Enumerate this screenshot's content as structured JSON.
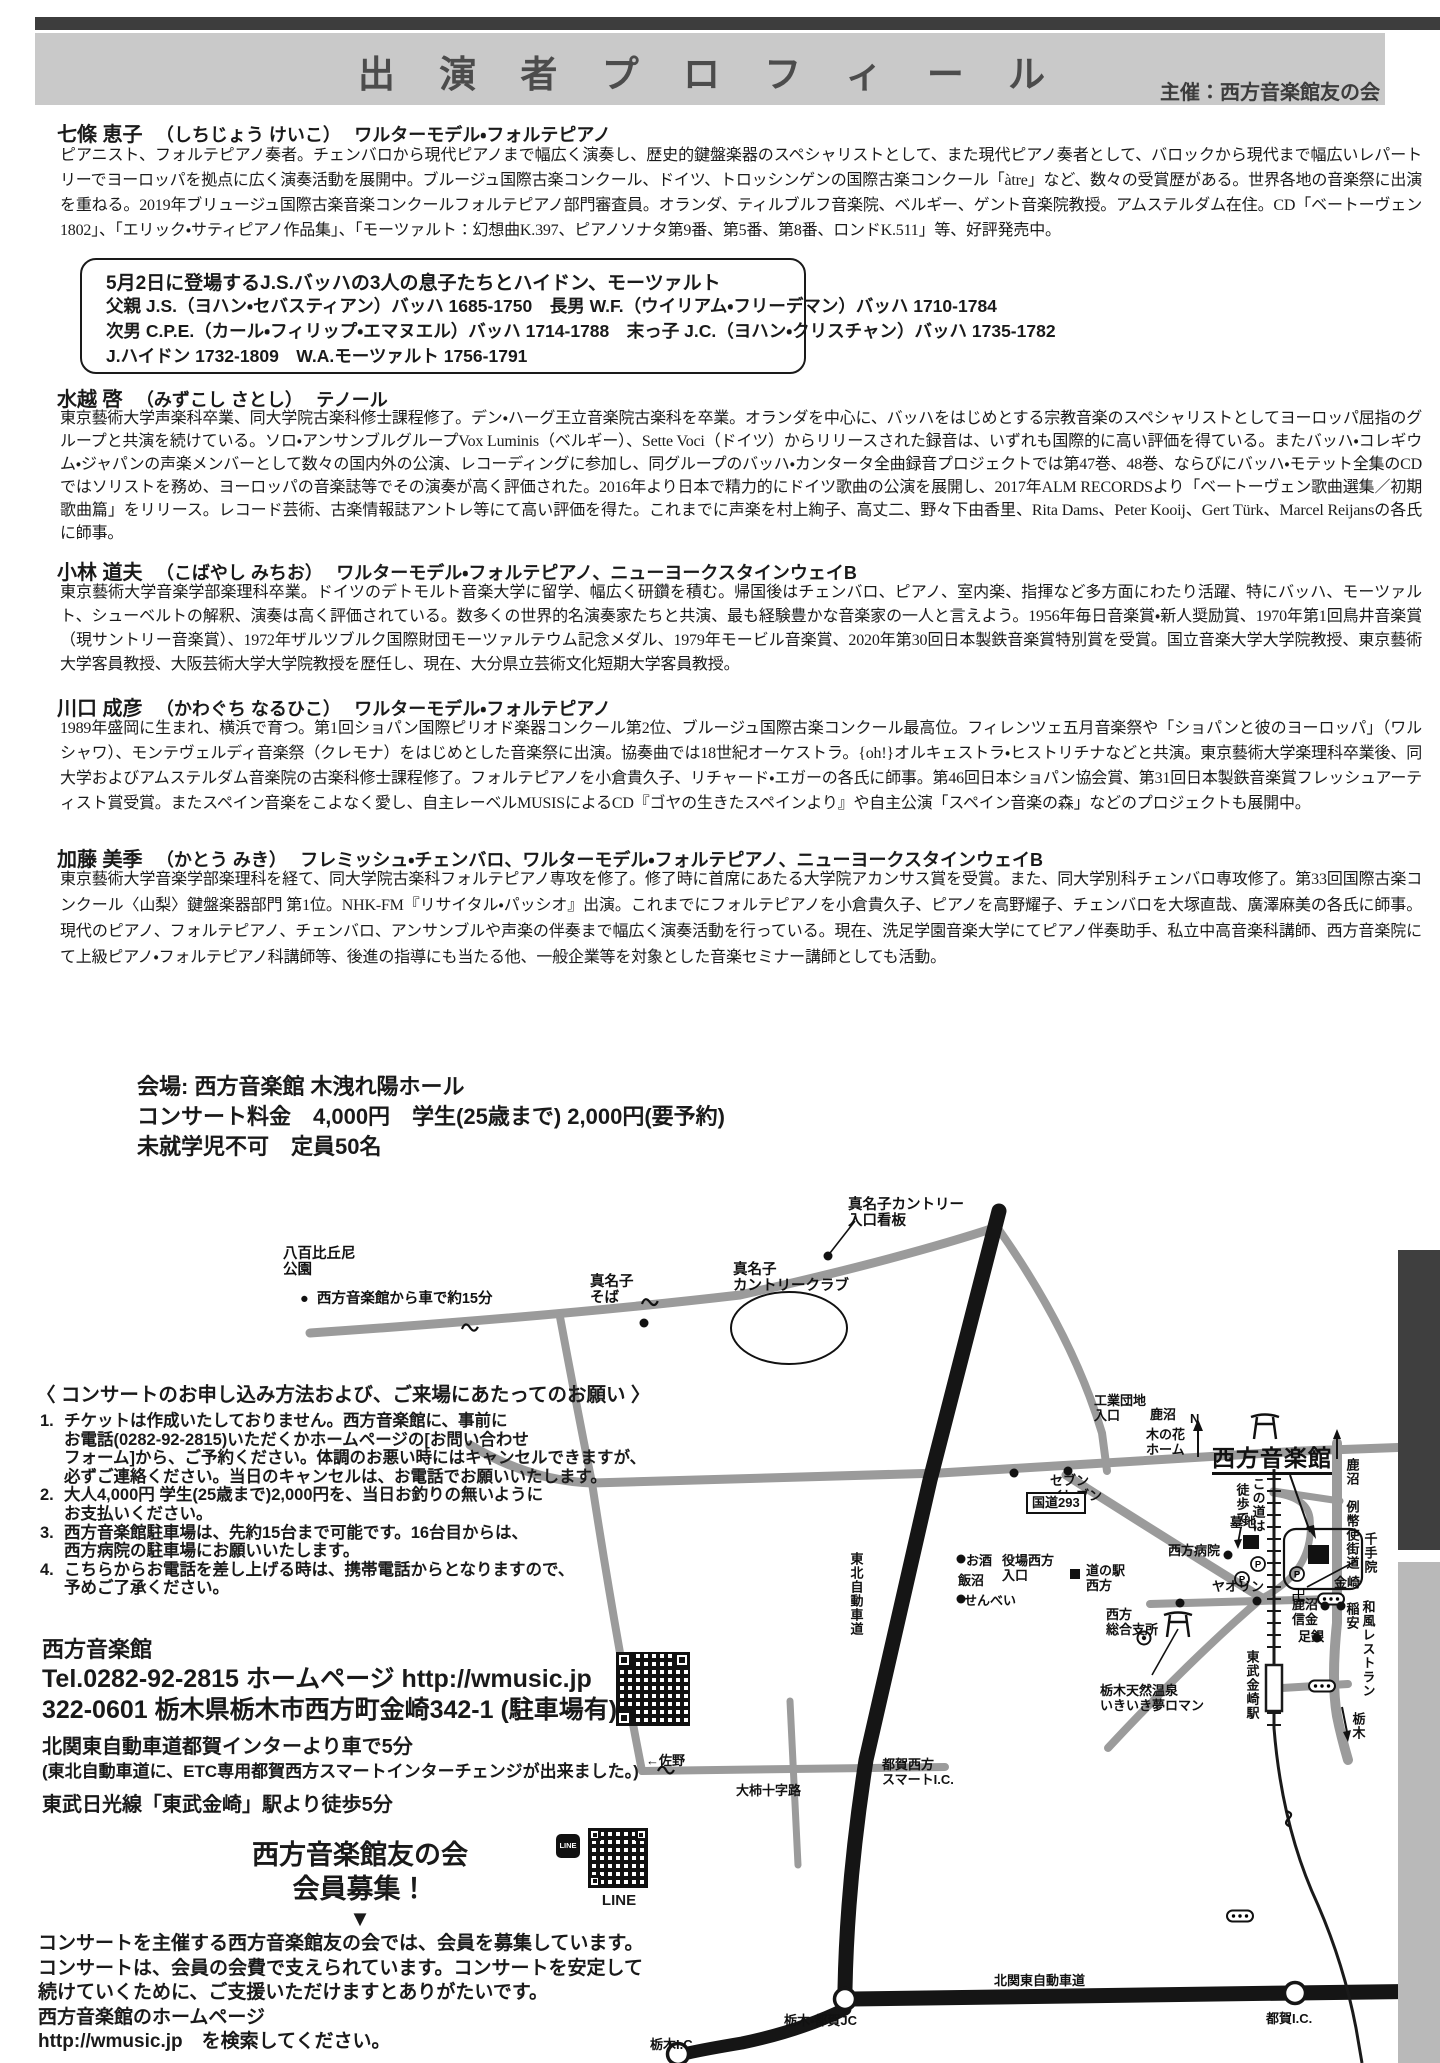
{
  "header": {
    "title": "出 演 者 プ ロ フ ィ ー ル",
    "organizer": "主催：西方音楽館友の会"
  },
  "profiles": [
    {
      "name": "七條 恵子",
      "kana": "（しちじょう けいこ）",
      "instrument": "ワルターモデル・フォルテピアノ",
      "bio": "ピアニスト、フォルテピアノ奏者。チェンバロから現代ピアノまで幅広く演奏し、歴史的鍵盤楽器のスペシャリストとして、また現代ピアノ奏者として、バロックから現代まで幅広いレパートリーでヨーロッパを拠点に広く演奏活動を展開中。ブルージュ国際古楽コンクール、ドイツ、トロッシンゲンの国際古楽コンクール「àtre」など、数々の受賞歴がある。世界各地の音楽祭に出演を重ねる。2019年ブリュージュ国際古楽音楽コンクールフォルテピアノ部門審査員。オランダ、ティルブルフ音楽院、ベルギー、ゲント音楽院教授。アムステルダム在住。CD「ベートーヴェン1802」、「エリック・サティピアノ作品集」、「モーツァルト：幻想曲K.397、ピアノソナタ第9番、第5番、第8番、ロンドK.511」等、好評発売中。"
    },
    {
      "name": "水越 啓",
      "kana": "（みずこし さとし）",
      "instrument": "テノール",
      "bio": "東京藝術大学声楽科卒業、同大学院古楽科修士課程修了。デン・ハーグ王立音楽院古楽科を卒業。オランダを中心に、バッハをはじめとする宗教音楽のスペシャリストとしてヨーロッパ屈指のグループと共演を続けている。ソロ・アンサンブルグループVox Luminis（ベルギー）、Sette Voci（ドイツ）からリリースされた録音は、いずれも国際的に高い評価を得ている。またバッハ・コレギウム・ジャパンの声楽メンバーとして数々の国内外の公演、レコーディングに参加し、同グループのバッハ・カンタータ全曲録音プロジェクトでは第47巻、48巻、ならびにバッハ・モテット全集のCDではソリストを務め、ヨーロッパの音楽誌等でその演奏が高く評価された。2016年より日本で精力的にドイツ歌曲の公演を展開し、2017年ALM RECORDSより「ベートーヴェン歌曲選集／初期歌曲篇」をリリース。レコード芸術、古楽情報誌アントレ等にて高い評価を得た。これまでに声楽を村上絢子、高丈二、野々下由香里、Rita Dams、Peter Kooij、Gert Türk、Marcel Reijansの各氏に師事。"
    },
    {
      "name": "小林 道夫",
      "kana": "（こばやし みちお）",
      "instrument": "ワルターモデル・フォルテピアノ、ニューヨークスタインウェイB",
      "bio": "東京藝術大学音楽学部楽理科卒業。ドイツのデトモルト音楽大学に留学、幅広く研鑽を積む。帰国後はチェンバロ、ピアノ、室内楽、指揮など多方面にわたり活躍、特にバッハ、モーツァルト、シューベルトの解釈、演奏は高く評価されている。数多くの世界的名演奏家たちと共演、最も経験豊かな音楽家の一人と言えよう。1956年毎日音楽賞・新人奨励賞、1970年第1回鳥井音楽賞（現サントリー音楽賞）、1972年ザルツブルク国際財団モーツァルテウム記念メダル、1979年モービル音楽賞、2020年第30回日本製鉄音楽賞特別賞を受賞。国立音楽大学大学院教授、東京藝術大学客員教授、大阪芸術大学大学院教授を歴任し、現在、大分県立芸術文化短期大学客員教授。"
    },
    {
      "name": "川口 成彦",
      "kana": "（かわぐち なるひこ）",
      "instrument": "ワルターモデル・フォルテピアノ",
      "bio": "1989年盛岡に生まれ、横浜で育つ。第1回ショパン国際ピリオド楽器コンクール第2位、ブルージュ国際古楽コンクール最高位。フィレンツェ五月音楽祭や「ショパンと彼のヨーロッパ」（ワルシャワ）、モンテヴェルディ音楽祭（クレモナ）をはじめとした音楽祭に出演。協奏曲では18世紀オーケストラ。{oh!}オルキェストラ・ヒストリチナなどと共演。東京藝術大学楽理科卒業後、同大学およびアムステルダム音楽院の古楽科修士課程修了。フォルテピアノを小倉貴久子、リチャード・エガーの各氏に師事。第46回日本ショパン協会賞、第31回日本製鉄音楽賞フレッシュアーティスト賞受賞。またスペイン音楽をこよなく愛し、自主レーベルMUSISによるCD『ゴヤの生きたスペインより』や自主公演「スペイン音楽の森」などのプロジェクトも展開中。"
    },
    {
      "name": "加藤 美季",
      "kana": "（かとう みき）",
      "instrument": "フレミッシュ・チェンバロ、ワルターモデル・フォルテピアノ、ニューヨークスタインウェイB",
      "bio": "東京藝術大学音楽学部楽理科を経て、同大学院古楽科フォルテピアノ専攻を修了。修了時に首席にあたる大学院アカンサス賞を受賞。また、同大学別科チェンバロ専攻修了。第33回国際古楽コンクール〈山梨〉鍵盤楽器部門 第1位。NHK-FM『リサイタル・パッシオ』出演。これまでにフォルテピアノを小倉貴久子、ピアノを高野耀子、チェンバロを大塚直哉、廣澤麻美の各氏に師事。現代のピアノ、フォルテピアノ、チェンバロ、アンサンブルや声楽の伴奏まで幅広く演奏活動を行っている。現在、洗足学園音楽大学にてピアノ伴奏助手、私立中高音楽科講師、西方音楽院にて上級ピアノ・フォルテピアノ科講師等、後進の指導にも当たる他、一般企業等を対象とした音楽セミナー講師としても活動。"
    }
  ],
  "info_box": {
    "title": "5月2日に登場するJ.S.バッハの3人の息子たちとハイドン、モーツァルト",
    "lines": "父親 J.S.（ヨハン・セバスティアン）バッハ 1685-1750　長男 W.F.（ウイリアム・フリーデマン）バッハ 1710-1784\n次男 C.P.E.（カール・フィリップ・エマヌエル）バッハ 1714-1788　末っ子 J.C.（ヨハン・クリスチャン）バッハ 1735-1782\nJ.ハイドン 1732-1809　W.A.モーツァルト 1756-1791"
  },
  "venue": {
    "text": "会場: 西方音楽館 木洩れ陽ホール\nコンサート料金　4,000円　学生(25歳まで) 2,000円(要予約)\n未就学児不可　定員50名"
  },
  "notice": {
    "title": "〈 コンサートのお申し込み方法および、ご来場にあたってのお願い 〉",
    "items": [
      {
        "num": "1.",
        "text": "チケットは作成いたしておりません。西方音楽館に、事前に\nお電話(0282-92-2815)いただくかホームページの[お問い合わせ\nフォーム]から、ご予約ください。体調のお悪い時にはキャンセルできますが、\n必ずご連絡ください。当日のキャンセルは、お電話でお願いいたします。"
      },
      {
        "num": "2.",
        "text": "大人4,000円 学生(25歳まで)2,000円を、当日お釣りの無いように\nお支払いください。"
      },
      {
        "num": "3.",
        "text": "西方音楽館駐車場は、先約15台まで可能です。16台目からは、\n西方病院の駐車場にお願いいたします。"
      },
      {
        "num": "4.",
        "text": "こちらからお電話を差し上げる時は、携帯電話からとなりますので、\n予めご了承ください。"
      }
    ]
  },
  "contact": {
    "name": "西方音楽館",
    "tel_line": "Tel.0282-92-2815  ホームページ  http://wmusic.jp",
    "address": "322-0601 栃木県栃木市西方町金崎342-1 (駐車場有)",
    "access_car": "北関東自動車道都賀インターより車で5分",
    "access_car_note": "(東北自動車道に、ETC専用都賀西方スマートインターチェンジが出来ました。)",
    "access_train": "東武日光線「東武金崎」駅より徒歩5分"
  },
  "fanclub": {
    "title": "西方音楽館友の会\n会員募集！",
    "arrow": "▼",
    "body": "コンサートを主催する西方音楽館友の会では、会員を募集しています。\nコンサートは、会員の会費で支えられています。コンサートを安定して\n続けていくために、ご支援いただけますとありがたいです。\n西方音楽館のホームページ\nhttp://wmusic.jp　を検索してください。",
    "line_label": "LINE",
    "line_badge": "LINE"
  },
  "map": {
    "labels": [
      {
        "text": "真名子カントリー\n入口看板",
        "x": 848,
        "y": 1197,
        "cls": "s",
        "name": "map-label-manago-sign"
      },
      {
        "text": "八百比丘尼\n公園",
        "x": 283,
        "y": 1246,
        "cls": "s",
        "name": "map-label-park"
      },
      {
        "text": "●  西方音楽館から車で約15分",
        "x": 300,
        "y": 1291,
        "cls": "s",
        "name": "map-label-15min"
      },
      {
        "text": "真名子\nそば",
        "x": 590,
        "y": 1274,
        "cls": "s",
        "name": "map-label-manago-soba"
      },
      {
        "text": "真名子\nカントリークラブ",
        "x": 733,
        "y": 1262,
        "cls": "s",
        "name": "map-label-country-club"
      },
      {
        "text": "工業団地\n入口",
        "x": 1094,
        "y": 1394,
        "cls": "",
        "name": "map-label-kogyo"
      },
      {
        "text": "鹿沼",
        "x": 1150,
        "y": 1408,
        "cls": "",
        "name": "map-label-kanuma-nw"
      },
      {
        "text": "木の花\nホーム",
        "x": 1146,
        "y": 1428,
        "cls": "",
        "name": "map-label-konohana"
      },
      {
        "text": "N",
        "x": 1190,
        "y": 1412,
        "cls": "",
        "name": "map-label-compass-n"
      },
      {
        "text": "セブン\nイレブン",
        "x": 1050,
        "y": 1474,
        "cls": "",
        "name": "map-label-seven-eleven"
      },
      {
        "text": "国道293",
        "x": 1026,
        "y": 1492,
        "cls": "boxed",
        "name": "map-label-route293"
      },
      {
        "text": "西方音楽館",
        "x": 1212,
        "y": 1446,
        "cls": "map-title",
        "name": "map-label-nishikata-hall"
      },
      {
        "text": "この道は",
        "x": 1250,
        "y": 1477,
        "cls": "v",
        "name": "map-label-konomichi"
      },
      {
        "text": "徒歩で",
        "x": 1234,
        "y": 1483,
        "cls": "v",
        "name": "map-label-toho"
      },
      {
        "text": "鹿沼",
        "x": 1344,
        "y": 1458,
        "cls": "v",
        "name": "map-label-kanuma-up"
      },
      {
        "text": "例幣使街道",
        "x": 1344,
        "y": 1500,
        "cls": "v",
        "name": "map-label-reiheishi"
      },
      {
        "text": "墓地",
        "x": 1230,
        "y": 1516,
        "cls": "",
        "name": "map-label-bochi"
      },
      {
        "text": "西方病院",
        "x": 1168,
        "y": 1544,
        "cls": "",
        "name": "map-label-hospital"
      },
      {
        "text": "ヤオリン",
        "x": 1212,
        "y": 1580,
        "cls": "",
        "name": "map-label-yaorin"
      },
      {
        "text": "千手院",
        "x": 1362,
        "y": 1532,
        "cls": "v",
        "name": "map-label-senjuin"
      },
      {
        "text": "金崎",
        "x": 1334,
        "y": 1576,
        "cls": "",
        "name": "map-label-kanasaki"
      },
      {
        "text": "鹿沼\n信金",
        "x": 1292,
        "y": 1598,
        "cls": "",
        "name": "map-label-shinkin"
      },
      {
        "text": "稲安",
        "x": 1344,
        "y": 1602,
        "cls": "v",
        "name": "map-label-inayasu"
      },
      {
        "text": "和風レストラン",
        "x": 1360,
        "y": 1600,
        "cls": "v",
        "name": "map-label-restaurant"
      },
      {
        "text": "足銀",
        "x": 1298,
        "y": 1630,
        "cls": "",
        "name": "map-label-ashigin"
      },
      {
        "text": "東武金崎駅",
        "x": 1244,
        "y": 1650,
        "cls": "v",
        "name": "map-label-tobu-kanasaki-sta"
      },
      {
        "text": "栃木",
        "x": 1350,
        "y": 1712,
        "cls": "v",
        "name": "map-label-tochigi-down"
      },
      {
        "text": "お酒",
        "x": 966,
        "y": 1554,
        "cls": "",
        "name": "map-label-osake"
      },
      {
        "text": "飯沼",
        "x": 958,
        "y": 1574,
        "cls": "",
        "name": "map-label-iinuma"
      },
      {
        "text": "せんべい",
        "x": 964,
        "y": 1594,
        "cls": "",
        "name": "map-label-senbei"
      },
      {
        "text": "役場西方\n入口",
        "x": 1002,
        "y": 1554,
        "cls": "",
        "name": "map-label-yakuba"
      },
      {
        "text": "道の駅\n西方",
        "x": 1086,
        "y": 1564,
        "cls": "",
        "name": "map-label-michinoeki"
      },
      {
        "text": "西方\n総合支所",
        "x": 1106,
        "y": 1608,
        "cls": "",
        "name": "map-label-shisho"
      },
      {
        "text": "栃木天然温泉\nいきいき夢ロマン",
        "x": 1100,
        "y": 1684,
        "cls": "",
        "name": "map-label-onsen"
      },
      {
        "text": "東北自動車道",
        "x": 848,
        "y": 1552,
        "cls": "v",
        "name": "map-label-tohoku-expwy"
      },
      {
        "text": "都賀西方\nスマートI.C.",
        "x": 882,
        "y": 1758,
        "cls": "",
        "name": "map-label-smart-ic"
      },
      {
        "text": "大柿十字路",
        "x": 736,
        "y": 1784,
        "cls": "",
        "name": "map-label-ogaki"
      },
      {
        "text": "←佐野",
        "x": 646,
        "y": 1754,
        "cls": "",
        "name": "map-label-sano"
      },
      {
        "text": "栃木・都賀JC",
        "x": 784,
        "y": 2014,
        "cls": "",
        "name": "map-label-tsuga-jc"
      },
      {
        "text": "北関東自動車道",
        "x": 994,
        "y": 1974,
        "cls": "",
        "name": "map-label-kitakanto"
      },
      {
        "text": "都賀I.C.",
        "x": 1266,
        "y": 2012,
        "cls": "",
        "name": "map-label-tsuga-ic"
      },
      {
        "text": "栃木I.C.",
        "x": 650,
        "y": 2038,
        "cls": "",
        "name": "map-label-tochigi-ic"
      },
      {
        "text": "鹿沼",
        "x": 1412,
        "y": 1438,
        "cls": "",
        "name": "map-label-kanuma-e"
      }
    ]
  }
}
